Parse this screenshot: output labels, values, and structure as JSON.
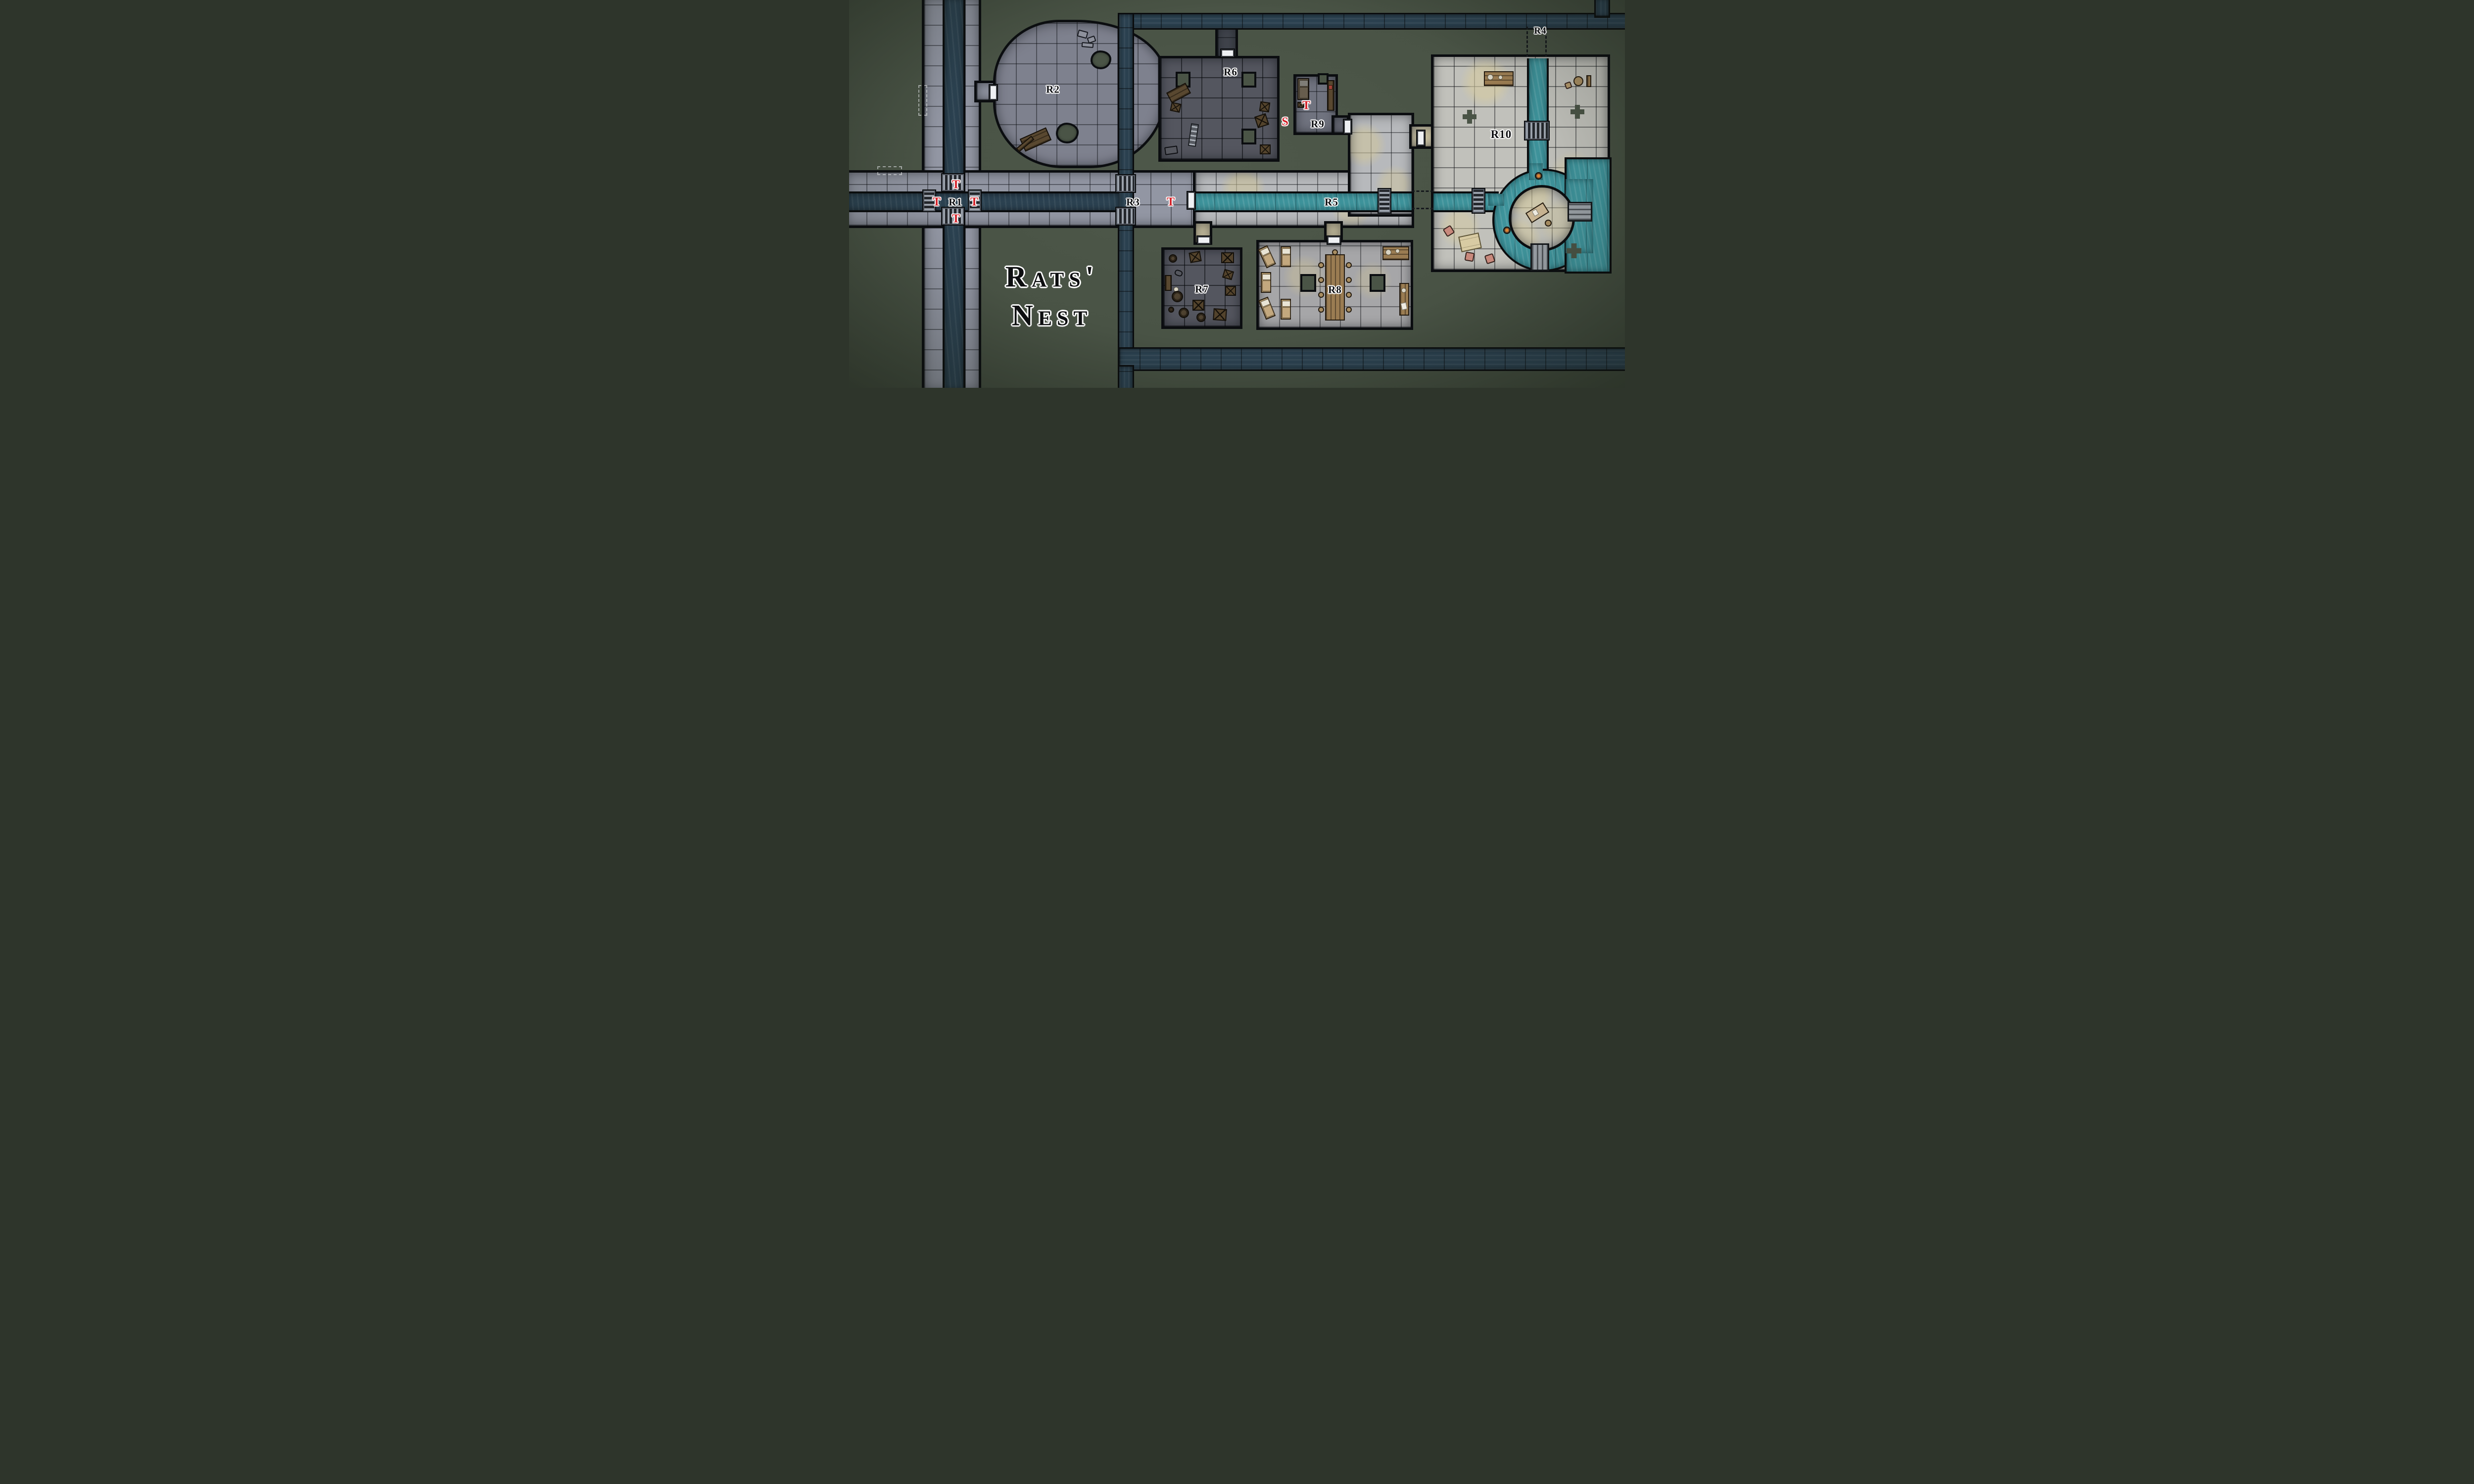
{
  "title": {
    "line1": "Rats'",
    "line2": "Nest"
  },
  "rooms": [
    {
      "id": "r1",
      "label": "R1"
    },
    {
      "id": "r2",
      "label": "R2"
    },
    {
      "id": "r3",
      "label": "R3"
    },
    {
      "id": "r4",
      "label": "R4"
    },
    {
      "id": "r5",
      "label": "R5"
    },
    {
      "id": "r6",
      "label": "R6"
    },
    {
      "id": "r7",
      "label": "R7"
    },
    {
      "id": "r8",
      "label": "R8"
    },
    {
      "id": "r9",
      "label": "R9"
    },
    {
      "id": "r10",
      "label": "R10"
    }
  ],
  "markers": {
    "traps": [
      {
        "id": "trap-r1-north",
        "label": "T"
      },
      {
        "id": "trap-r1-west",
        "label": "T"
      },
      {
        "id": "trap-r1-east",
        "label": "T"
      },
      {
        "id": "trap-r1-south",
        "label": "T"
      },
      {
        "id": "trap-r3",
        "label": "T"
      },
      {
        "id": "trap-r9",
        "label": "T"
      }
    ],
    "secrets": [
      {
        "id": "secret-door-near-r9",
        "label": "S"
      }
    ]
  },
  "colors": {
    "background": "#4a5446",
    "water_dark": "#2b4150",
    "water_bright": "#3e939b",
    "marker_red": "#d41f27",
    "stone_light": "#b7b9bc",
    "stone_dark": "#54565f",
    "label_ink": "#0d0e11"
  }
}
